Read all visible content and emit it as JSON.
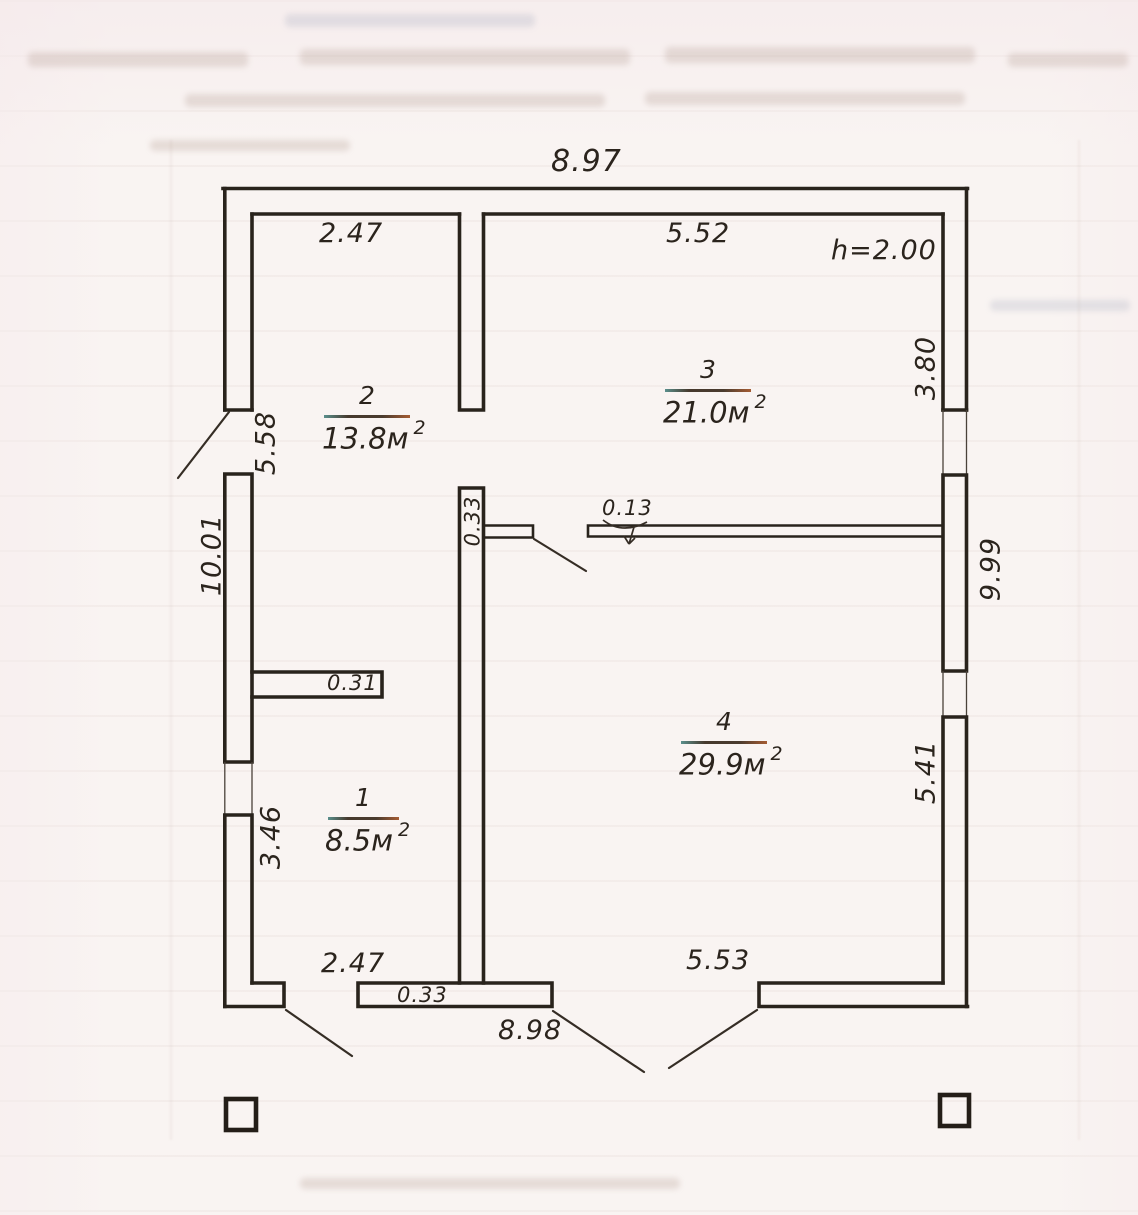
{
  "plan": {
    "height_note": "h=2.00",
    "dims": {
      "top_overall": "8.97",
      "room2_width": "2.47",
      "room3_width": "5.52",
      "left_upper": "5.58",
      "left_overall": "10.01",
      "right_upper": "3.80",
      "right_overall": "9.99",
      "right_lower": "5.41",
      "left_lower": "3.46",
      "room1_width": "2.47",
      "bottom_overall": "8.98",
      "room4_width": "5.53",
      "mid_wall_thickness": "0.33",
      "bottom_wall_thickness": "0.33",
      "partition_thickness": "0.13",
      "stub_wall_thickness": "0.31"
    },
    "rooms": [
      {
        "number": "1",
        "area": "8.5м",
        "area_sup": "2"
      },
      {
        "number": "2",
        "area": "13.8м",
        "area_sup": "2"
      },
      {
        "number": "3",
        "area": "21.0м",
        "area_sup": "2"
      },
      {
        "number": "4",
        "area": "29.9м",
        "area_sup": "2"
      }
    ]
  }
}
